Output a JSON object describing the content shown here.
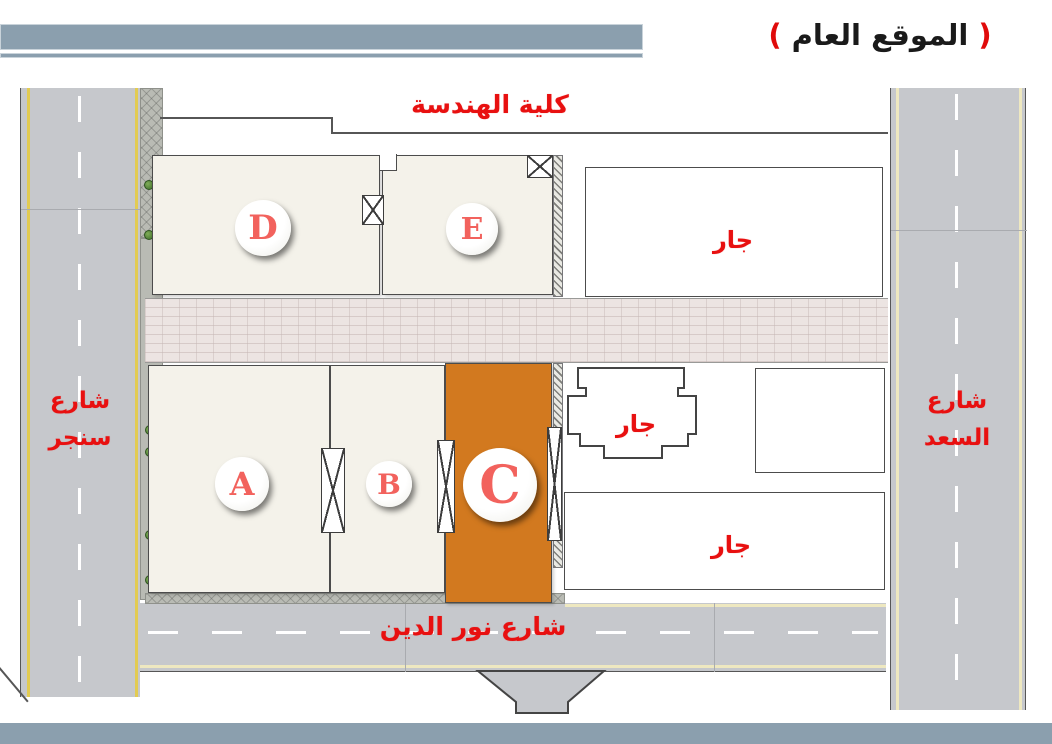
{
  "title": {
    "open": "(",
    "text": "الموقع العام",
    "close": ")"
  },
  "plan": {
    "top_label": "كلية الهندسة",
    "streets": {
      "left": {
        "line1": "شارع",
        "line2": "سنجر"
      },
      "right": {
        "line1": "شارع",
        "line2": "السعد"
      },
      "bottom": "شارع نور الدين"
    },
    "buildings": {
      "a": "A",
      "b": "B",
      "c": "C",
      "d": "D",
      "e": "E"
    },
    "neighbors": [
      "جار",
      "جار",
      "جار"
    ],
    "highlighted_building": "C"
  },
  "colors": {
    "header_bar": "#8b9fae",
    "road": "#c6c8cc",
    "road_edge_yellow": "#e2cb52",
    "road_edge_pale": "#eee8c0",
    "lane_dash": "#ffffff",
    "building_fill": "#f4f2ea",
    "building_c_fill": "#d2791f",
    "walkway_fill": "#ece4e2",
    "sidewalk_fill": "#b9bbb4",
    "outline": "#4c4c4c",
    "label_red": "#e81010",
    "circle_letter": "#f2625d"
  }
}
